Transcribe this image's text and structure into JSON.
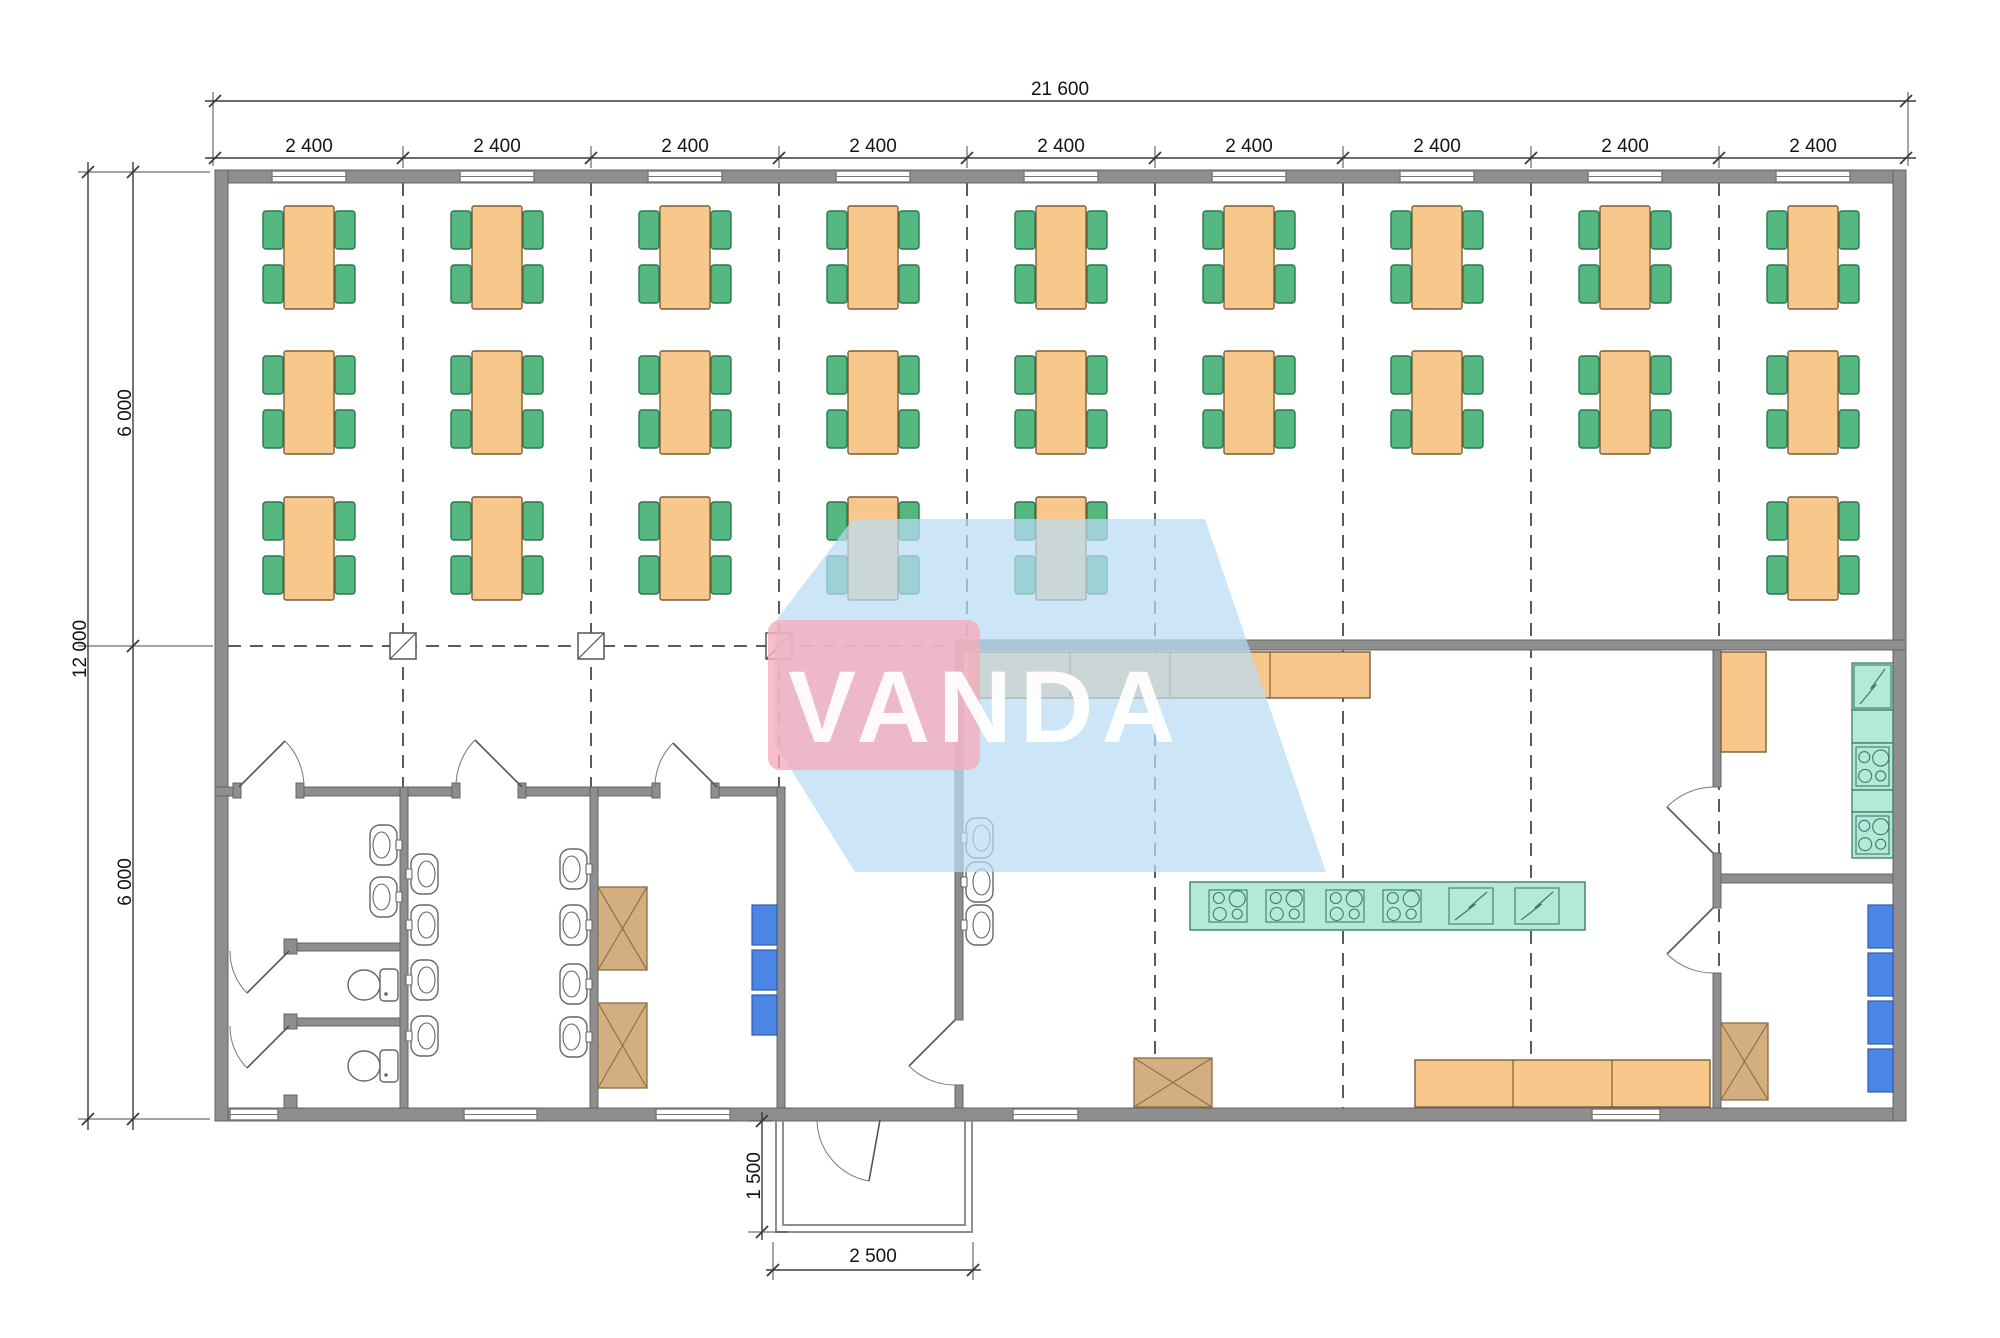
{
  "watermark": {
    "text": "VANDA",
    "pink_color": "rgba(245,173,186,0.80)",
    "blue_color": "rgba(186,220,244,0.72)",
    "blue_polygon": "775,622 853,519 1205,519 1243,630 1326,872 855,872 775,744",
    "pink_rect": {
      "x": 768,
      "y": 620,
      "w": 212,
      "h": 150,
      "rx": 12
    },
    "text_pos": {
      "x": 788,
      "y": 742
    }
  },
  "dimensions": {
    "total_width": "21 600",
    "bay_width": "2 400",
    "total_height": "12 000",
    "half_height": "6 000",
    "porch_depth": "1 500",
    "porch_width": "2 500",
    "bay_label_y": 152,
    "bay_centers": [
      309,
      497,
      685,
      873,
      1061,
      1249,
      1437,
      1625,
      1813
    ]
  },
  "palette": {
    "wall_fill": "#8e8e8e",
    "wall_stroke": "#646464",
    "dash": "#5c5c5c",
    "ext": "#4a4a4a",
    "dim": "#3a3a3a",
    "table_fill": "#f8c78c",
    "table_stroke": "#7c5f36",
    "chair_fill": "#54b880",
    "chair_stroke": "#2c7550",
    "teal_fill": "#b4e8d9",
    "teal_stroke": "#3c7c6c",
    "blue_fill": "#4c86e4",
    "blue_stroke": "#2d5cab",
    "brown_fill": "#d2ae80",
    "brown_stroke": "#8c6e44",
    "fixture_stroke": "#666666",
    "porch": "#8e8e8e",
    "window_stroke": "#777777"
  },
  "plan": {
    "canvas": {
      "w": 2000,
      "h": 1338
    },
    "grid_vlines": [
      {
        "x": 403,
        "y1": 183,
        "y2": 1108
      },
      {
        "x": 591,
        "y1": 183,
        "y2": 1108
      },
      {
        "x": 779,
        "y1": 183,
        "y2": 1108
      },
      {
        "x": 967,
        "y1": 183,
        "y2": 645
      },
      {
        "x": 1155,
        "y1": 183,
        "y2": 1108
      },
      {
        "x": 1343,
        "y1": 183,
        "y2": 1108
      },
      {
        "x": 1531,
        "y1": 183,
        "y2": 1108
      },
      {
        "x": 1719,
        "y1": 183,
        "y2": 1108
      }
    ],
    "grid_hlines": [
      {
        "y": 646,
        "x1": 228,
        "x2": 955
      }
    ],
    "column_symbols": [
      {
        "x": 403,
        "y": 646
      },
      {
        "x": 591,
        "y": 646
      },
      {
        "x": 779,
        "y": 646
      }
    ],
    "walls": [
      {
        "x": 215,
        "y": 170,
        "w": 1691,
        "h": 13,
        "n": "wall-exterior-top"
      },
      {
        "x": 215,
        "y": 1108,
        "w": 1691,
        "h": 13,
        "n": "wall-exterior-bottom"
      },
      {
        "x": 215,
        "y": 170,
        "w": 13,
        "h": 951,
        "n": "wall-exterior-left"
      },
      {
        "x": 1893,
        "y": 170,
        "w": 13,
        "h": 951,
        "n": "wall-exterior-right"
      },
      {
        "x": 215,
        "y": 787,
        "w": 24,
        "h": 9,
        "n": "wall-washrooms-north"
      },
      {
        "x": 300,
        "y": 787,
        "w": 156,
        "h": 9,
        "n": "wall-washrooms-north"
      },
      {
        "x": 522,
        "y": 787,
        "w": 134,
        "h": 9,
        "n": "wall-washrooms-north"
      },
      {
        "x": 715,
        "y": 787,
        "w": 70,
        "h": 9,
        "n": "wall-washrooms-north"
      },
      {
        "x": 233,
        "y": 783,
        "w": 8,
        "h": 15,
        "n": "door-jamb"
      },
      {
        "x": 296,
        "y": 783,
        "w": 8,
        "h": 15,
        "n": "door-jamb"
      },
      {
        "x": 452,
        "y": 783,
        "w": 8,
        "h": 15,
        "n": "door-jamb"
      },
      {
        "x": 518,
        "y": 783,
        "w": 8,
        "h": 15,
        "n": "door-jamb"
      },
      {
        "x": 652,
        "y": 783,
        "w": 8,
        "h": 15,
        "n": "door-jamb"
      },
      {
        "x": 711,
        "y": 783,
        "w": 8,
        "h": 15,
        "n": "door-jamb"
      },
      {
        "x": 400,
        "y": 787,
        "w": 8,
        "h": 321,
        "n": "wall-toilet-washroom"
      },
      {
        "x": 590,
        "y": 787,
        "w": 8,
        "h": 321,
        "n": "wall-washroom-lockerroom"
      },
      {
        "x": 777,
        "y": 787,
        "w": 8,
        "h": 321,
        "n": "wall-lockerroom-hall"
      },
      {
        "x": 955,
        "y": 645,
        "w": 8,
        "h": 375,
        "n": "wall-hall-kitchen"
      },
      {
        "x": 955,
        "y": 1085,
        "w": 8,
        "h": 23,
        "n": "wall-hall-kitchen-stub"
      },
      {
        "x": 955,
        "y": 640,
        "w": 951,
        "h": 10,
        "n": "wall-kitchen-north"
      },
      {
        "x": 1713,
        "y": 650,
        "w": 8,
        "h": 137,
        "n": "wall-kitchen-east"
      },
      {
        "x": 1713,
        "y": 853,
        "w": 8,
        "h": 55,
        "n": "wall-kitchen-east"
      },
      {
        "x": 1713,
        "y": 973,
        "w": 8,
        "h": 135,
        "n": "wall-kitchen-east"
      },
      {
        "x": 1721,
        "y": 874,
        "w": 172,
        "h": 9,
        "n": "wall-rightrooms-divider"
      },
      {
        "x": 287,
        "y": 943,
        "w": 113,
        "h": 8,
        "n": "wall-toilet-stall"
      },
      {
        "x": 287,
        "y": 1018,
        "w": 113,
        "h": 8,
        "n": "wall-toilet-stall"
      },
      {
        "x": 284,
        "y": 939,
        "w": 13,
        "h": 15,
        "n": "stall-door-stub"
      },
      {
        "x": 284,
        "y": 1014,
        "w": 13,
        "h": 15,
        "n": "stall-door-stub"
      },
      {
        "x": 284,
        "y": 1095,
        "w": 13,
        "h": 13,
        "n": "stall-door-stub"
      }
    ],
    "windows": [
      {
        "x": 272,
        "y": 171,
        "w": 74,
        "h": 11
      },
      {
        "x": 460,
        "y": 171,
        "w": 74,
        "h": 11
      },
      {
        "x": 648,
        "y": 171,
        "w": 74,
        "h": 11
      },
      {
        "x": 836,
        "y": 171,
        "w": 74,
        "h": 11
      },
      {
        "x": 1024,
        "y": 171,
        "w": 74,
        "h": 11
      },
      {
        "x": 1212,
        "y": 171,
        "w": 74,
        "h": 11
      },
      {
        "x": 1400,
        "y": 171,
        "w": 74,
        "h": 11
      },
      {
        "x": 1588,
        "y": 171,
        "w": 74,
        "h": 11
      },
      {
        "x": 1776,
        "y": 171,
        "w": 74,
        "h": 11
      },
      {
        "x": 230,
        "y": 1109,
        "w": 48,
        "h": 11
      },
      {
        "x": 464,
        "y": 1109,
        "w": 73,
        "h": 11
      },
      {
        "x": 656,
        "y": 1109,
        "w": 74,
        "h": 11
      },
      {
        "x": 1013,
        "y": 1109,
        "w": 65,
        "h": 11
      },
      {
        "x": 1592,
        "y": 1109,
        "w": 68,
        "h": 11
      }
    ],
    "doors": [
      {
        "leaf": [
          239,
          787,
          285,
          741
        ],
        "arc": "M304,787 A65,65 0 0 0 285,741",
        "n": "door-toilet-room"
      },
      {
        "leaf": [
          522,
          787,
          475,
          740
        ],
        "arc": "M456,787 A66,66 0 0 1 475,740",
        "n": "door-washroom"
      },
      {
        "leaf": [
          717,
          787,
          673,
          743
        ],
        "arc": "M655,787 A62,62 0 0 1 673,743",
        "n": "door-locker-room"
      },
      {
        "leaf": [
          955,
          1020,
          909,
          1066
        ],
        "arc": "M955,1085 A65,65 0 0 1 909,1066",
        "n": "door-hall-kitchen"
      },
      {
        "leaf": [
          880,
          1120,
          869,
          1181
        ],
        "arc": "M817,1120 A63,63 0 0 0 869,1181",
        "n": "door-main-entrance"
      },
      {
        "leaf": [
          1713,
          853,
          1667,
          807
        ],
        "arc": "M1713,787 A66,66 0 0 0 1667,807",
        "n": "door-storage-top"
      },
      {
        "leaf": [
          1713,
          908,
          1667,
          954
        ],
        "arc": "M1713,973 A65,65 0 0 1 1667,954",
        "n": "door-storage-bottom"
      },
      {
        "leaf": [
          289,
          951,
          247,
          993
        ],
        "arc": "M230,951 A59,59 0 0 0 247,993",
        "n": "door-stall-1"
      },
      {
        "leaf": [
          289,
          1026,
          247,
          1068
        ],
        "arc": "M230,1026 A59,59 0 0 0 247,1068",
        "n": "door-stall-2"
      }
    ],
    "tables": [
      {
        "cx": 309,
        "y": 206
      },
      {
        "cx": 497,
        "y": 206
      },
      {
        "cx": 685,
        "y": 206
      },
      {
        "cx": 873,
        "y": 206
      },
      {
        "cx": 1061,
        "y": 206
      },
      {
        "cx": 1249,
        "y": 206
      },
      {
        "cx": 1437,
        "y": 206
      },
      {
        "cx": 1625,
        "y": 206
      },
      {
        "cx": 1813,
        "y": 206
      },
      {
        "cx": 309,
        "y": 351
      },
      {
        "cx": 497,
        "y": 351
      },
      {
        "cx": 685,
        "y": 351
      },
      {
        "cx": 873,
        "y": 351
      },
      {
        "cx": 1061,
        "y": 351
      },
      {
        "cx": 1249,
        "y": 351
      },
      {
        "cx": 1437,
        "y": 351
      },
      {
        "cx": 1625,
        "y": 351
      },
      {
        "cx": 1813,
        "y": 351
      },
      {
        "cx": 309,
        "y": 497
      },
      {
        "cx": 497,
        "y": 497
      },
      {
        "cx": 685,
        "y": 497
      },
      {
        "cx": 873,
        "y": 497
      },
      {
        "cx": 1061,
        "y": 497
      },
      {
        "cx": 1813,
        "y": 497
      }
    ],
    "counters": [
      {
        "x": 970,
        "y": 652,
        "w": 400,
        "h": 46,
        "dividers": [
          1070,
          1170,
          1270
        ],
        "n": "serving-counter"
      },
      {
        "x": 1415,
        "y": 1060,
        "w": 295,
        "h": 47,
        "dividers": [
          1513,
          1612
        ],
        "n": "kitchen-worktable"
      },
      {
        "x": 1721,
        "y": 652,
        "w": 45,
        "h": 100,
        "dividers": [],
        "n": "storage-counter"
      }
    ],
    "island": {
      "x": 1190,
      "y": 882,
      "w": 395,
      "h": 48,
      "stoves": [
        {
          "x": 1205,
          "w": 46
        },
        {
          "x": 1262,
          "w": 46
        },
        {
          "x": 1322,
          "w": 46
        },
        {
          "x": 1379,
          "w": 46
        }
      ],
      "fryers": [
        {
          "x": 1447,
          "w": 48
        },
        {
          "x": 1513,
          "w": 48
        }
      ]
    },
    "teal_strip": {
      "x": 1852,
      "w": 41,
      "modules": [
        {
          "y": 663,
          "h": 47,
          "t": "zig"
        },
        {
          "y": 710,
          "h": 33,
          "t": "plain"
        },
        {
          "y": 743,
          "h": 47,
          "t": "stove"
        },
        {
          "y": 790,
          "h": 22,
          "t": "plain"
        },
        {
          "y": 812,
          "h": 46,
          "t": "stove"
        }
      ]
    },
    "x_cabinets": [
      {
        "x": 598,
        "y": 887,
        "w": 49,
        "h": 83
      },
      {
        "x": 598,
        "y": 1003,
        "w": 49,
        "h": 85
      },
      {
        "x": 1134,
        "y": 1058,
        "w": 78,
        "h": 49
      },
      {
        "x": 1721,
        "y": 1023,
        "w": 47,
        "h": 77
      }
    ],
    "lockers": [
      {
        "x": 752,
        "y": 905,
        "w": 25,
        "h": 40
      },
      {
        "x": 752,
        "y": 950,
        "w": 25,
        "h": 40
      },
      {
        "x": 752,
        "y": 995,
        "w": 25,
        "h": 40
      },
      {
        "x": 1868,
        "y": 905,
        "w": 25,
        "h": 43
      },
      {
        "x": 1868,
        "y": 953,
        "w": 25,
        "h": 43
      },
      {
        "x": 1868,
        "y": 1001,
        "w": 25,
        "h": 43
      },
      {
        "x": 1868,
        "y": 1049,
        "w": 25,
        "h": 43
      }
    ],
    "sinks": [
      {
        "x": 400,
        "yc": 845,
        "dir": -1
      },
      {
        "x": 400,
        "yc": 897,
        "dir": -1
      },
      {
        "x": 408,
        "yc": 874,
        "dir": 1
      },
      {
        "x": 408,
        "yc": 925,
        "dir": 1
      },
      {
        "x": 408,
        "yc": 980,
        "dir": 1
      },
      {
        "x": 408,
        "yc": 1036,
        "dir": 1
      },
      {
        "x": 590,
        "yc": 869,
        "dir": -1
      },
      {
        "x": 590,
        "yc": 925,
        "dir": -1
      },
      {
        "x": 590,
        "yc": 984,
        "dir": -1
      },
      {
        "x": 590,
        "yc": 1037,
        "dir": -1
      },
      {
        "x": 963,
        "yc": 838,
        "dir": 1
      },
      {
        "x": 963,
        "yc": 882,
        "dir": 1
      },
      {
        "x": 963,
        "yc": 925,
        "dir": 1
      }
    ],
    "toilets": [
      {
        "wx": 400,
        "yc": 985
      },
      {
        "wx": 400,
        "yc": 1066
      }
    ],
    "porch_paths": [
      "M776,1121 L776,1232 L972,1232 L972,1121",
      "M783,1121 L783,1225 L965,1225 L965,1121"
    ],
    "dim_lines": [
      {
        "x1": 205,
        "y1": 101,
        "x2": 1916,
        "y2": 101,
        "ticks": [
          [
            215,
            101
          ],
          [
            1906,
            101
          ]
        ]
      },
      {
        "x1": 205,
        "y1": 158,
        "x2": 1916,
        "y2": 158,
        "ticks": [
          [
            215,
            158
          ],
          [
            403,
            158
          ],
          [
            591,
            158
          ],
          [
            779,
            158
          ],
          [
            967,
            158
          ],
          [
            1155,
            158
          ],
          [
            1343,
            158
          ],
          [
            1531,
            158
          ],
          [
            1719,
            158
          ],
          [
            1906,
            158
          ]
        ]
      },
      {
        "x1": 88,
        "y1": 162,
        "x2": 88,
        "y2": 1130,
        "ticks": [
          [
            88,
            172
          ],
          [
            88,
            1119
          ]
        ]
      },
      {
        "x1": 133,
        "y1": 162,
        "x2": 133,
        "y2": 1130,
        "ticks": [
          [
            133,
            172
          ],
          [
            133,
            646
          ],
          [
            133,
            1119
          ]
        ]
      },
      {
        "x1": 762,
        "y1": 1112,
        "x2": 762,
        "y2": 1240,
        "ticks": [
          [
            762,
            1121
          ],
          [
            762,
            1232
          ]
        ]
      },
      {
        "x1": 766,
        "y1": 1270,
        "x2": 981,
        "y2": 1270,
        "ticks": [
          [
            773,
            1270
          ],
          [
            973,
            1270
          ]
        ]
      }
    ],
    "ext_lines": [
      {
        "x1": 213,
        "y1": 92,
        "x2": 213,
        "y2": 166
      },
      {
        "x1": 1908,
        "y1": 92,
        "x2": 1908,
        "y2": 166
      },
      {
        "x1": 403,
        "y1": 146,
        "x2": 403,
        "y2": 168
      },
      {
        "x1": 591,
        "y1": 146,
        "x2": 591,
        "y2": 168
      },
      {
        "x1": 779,
        "y1": 146,
        "x2": 779,
        "y2": 168
      },
      {
        "x1": 967,
        "y1": 146,
        "x2": 967,
        "y2": 168
      },
      {
        "x1": 1155,
        "y1": 146,
        "x2": 1155,
        "y2": 168
      },
      {
        "x1": 1343,
        "y1": 146,
        "x2": 1343,
        "y2": 168
      },
      {
        "x1": 1531,
        "y1": 146,
        "x2": 1531,
        "y2": 168
      },
      {
        "x1": 1719,
        "y1": 146,
        "x2": 1719,
        "y2": 168
      },
      {
        "x1": 78,
        "y1": 172,
        "x2": 210,
        "y2": 172
      },
      {
        "x1": 78,
        "y1": 646,
        "x2": 213,
        "y2": 646
      },
      {
        "x1": 78,
        "y1": 1119,
        "x2": 210,
        "y2": 1119
      },
      {
        "x1": 748,
        "y1": 1121,
        "x2": 772,
        "y2": 1121
      },
      {
        "x1": 748,
        "y1": 1232,
        "x2": 788,
        "y2": 1232
      },
      {
        "x1": 773,
        "y1": 1242,
        "x2": 773,
        "y2": 1280
      },
      {
        "x1": 973,
        "y1": 1242,
        "x2": 973,
        "y2": 1280
      }
    ]
  }
}
